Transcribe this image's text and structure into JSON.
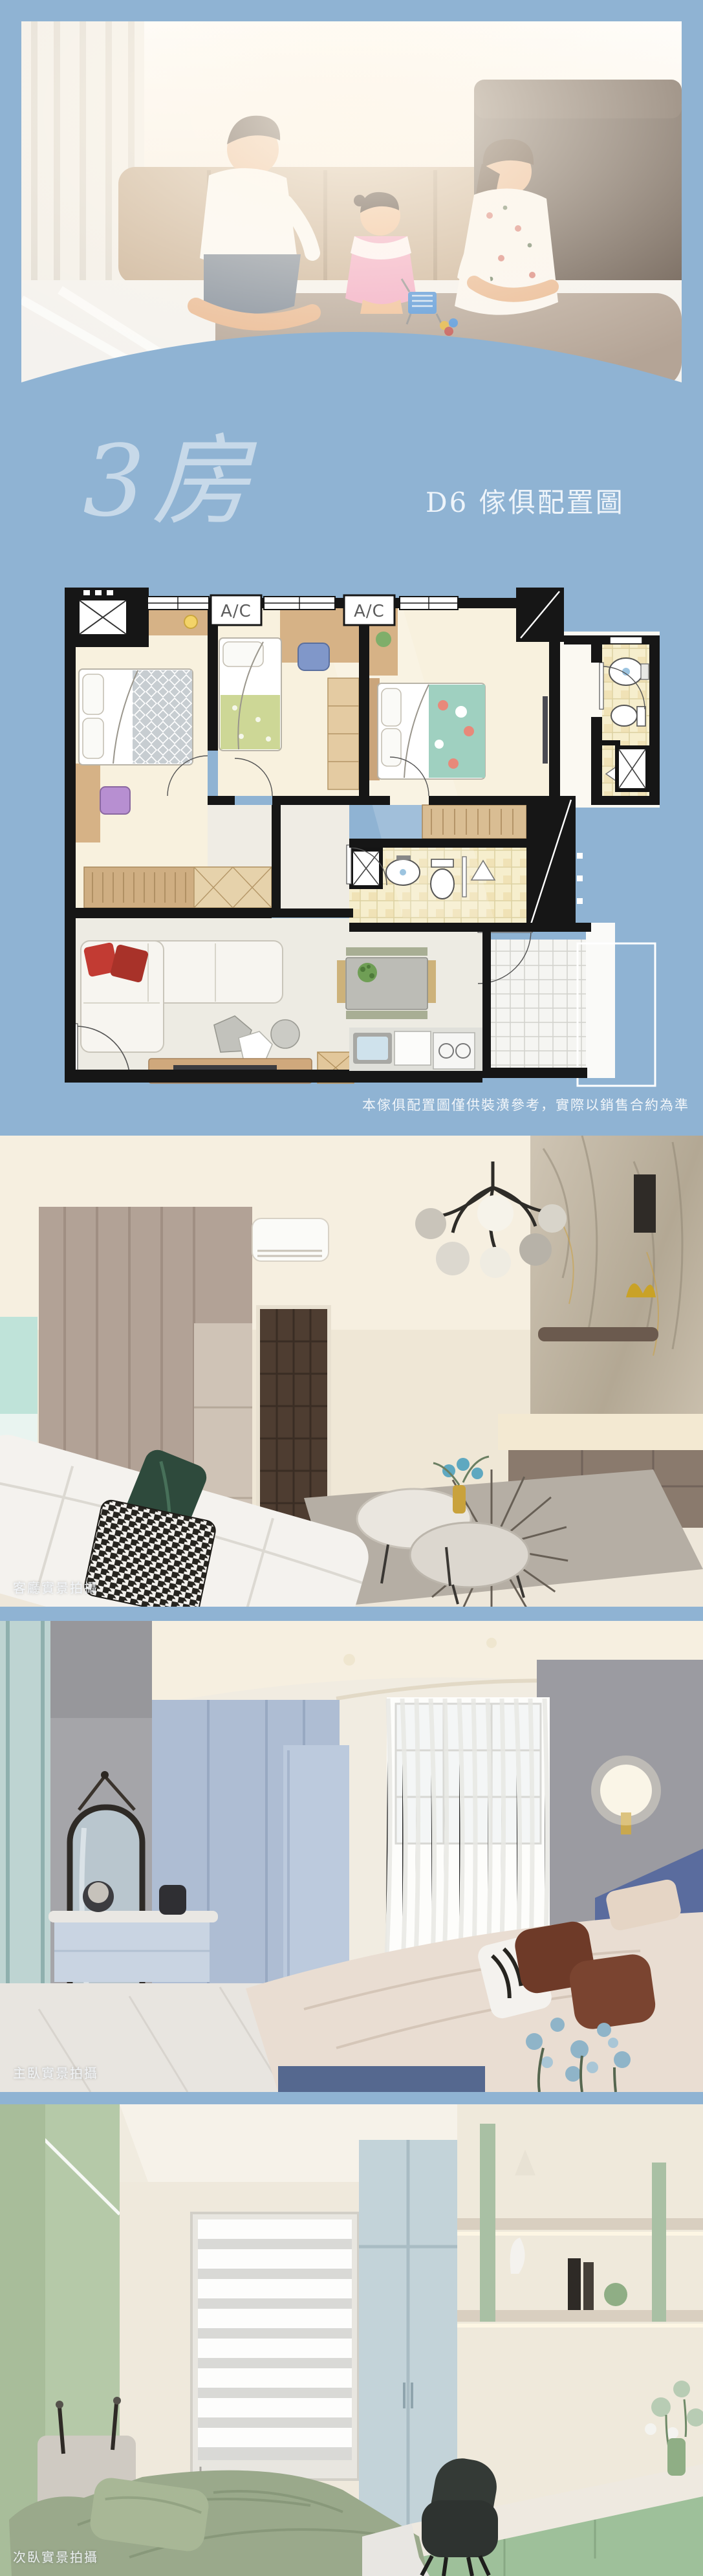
{
  "theme": {
    "background_color": "#8fb3d3",
    "title_color": "#c7d9e9",
    "caption_color": "#f2f6fa"
  },
  "header": {
    "title": "3房",
    "subtitle": "D6 傢俱配置圖"
  },
  "floor_plan": {
    "ac_labels": [
      "A/C",
      "A/C"
    ],
    "disclaimer": "本傢俱配置圖僅供裝潢參考，實際以銷售合約為準"
  },
  "photos": [
    {
      "caption": "客廳實景拍攝"
    },
    {
      "caption": "主臥實景拍攝"
    },
    {
      "caption": "次臥實景拍攝"
    }
  ]
}
